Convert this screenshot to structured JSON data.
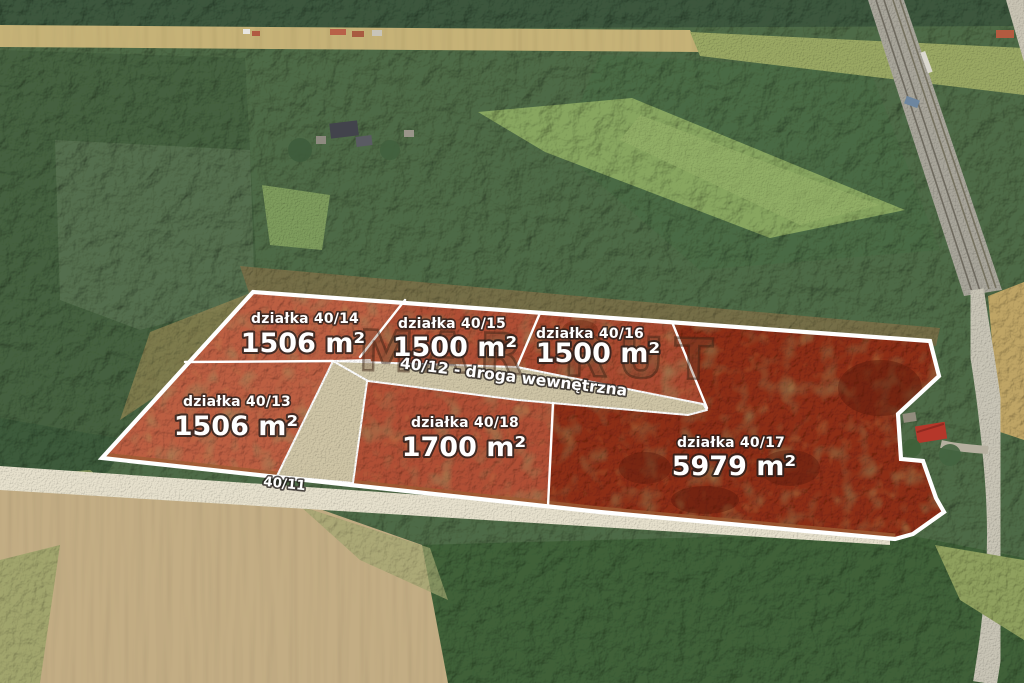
{
  "scene": {
    "description_label": "aerial drone photo of forest, fields, railway and highlighted building plots",
    "watermark": {
      "text": "MAR RUT"
    },
    "plots": [
      {
        "id": "40/14",
        "name_label": "działka 40/14",
        "area_label": "1506 m²"
      },
      {
        "id": "40/15",
        "name_label": "działka 40/15",
        "area_label": "1500 m²"
      },
      {
        "id": "40/16",
        "name_label": "działka 40/16",
        "area_label": "1500 m²"
      },
      {
        "id": "40/13",
        "name_label": "działka 40/13",
        "area_label": "1506 m²"
      },
      {
        "id": "40/18",
        "name_label": "działka 40/18",
        "area_label": "1700 m²"
      },
      {
        "id": "40/17",
        "name_label": "działka 40/17",
        "area_label": "5979 m²"
      }
    ],
    "roads": {
      "internal_label": "40/12 - droga wewnętrzna",
      "access_label": "40/11"
    },
    "colors": {
      "boundary": "#ffffff",
      "tint_light": "#bc5f43",
      "tint_mid": "#b05036",
      "tint_mid2": "#a84a30",
      "tint_dark": "#8c2e16",
      "internal_road": "#cfc5a6",
      "label_text": "#ffffff"
    }
  }
}
